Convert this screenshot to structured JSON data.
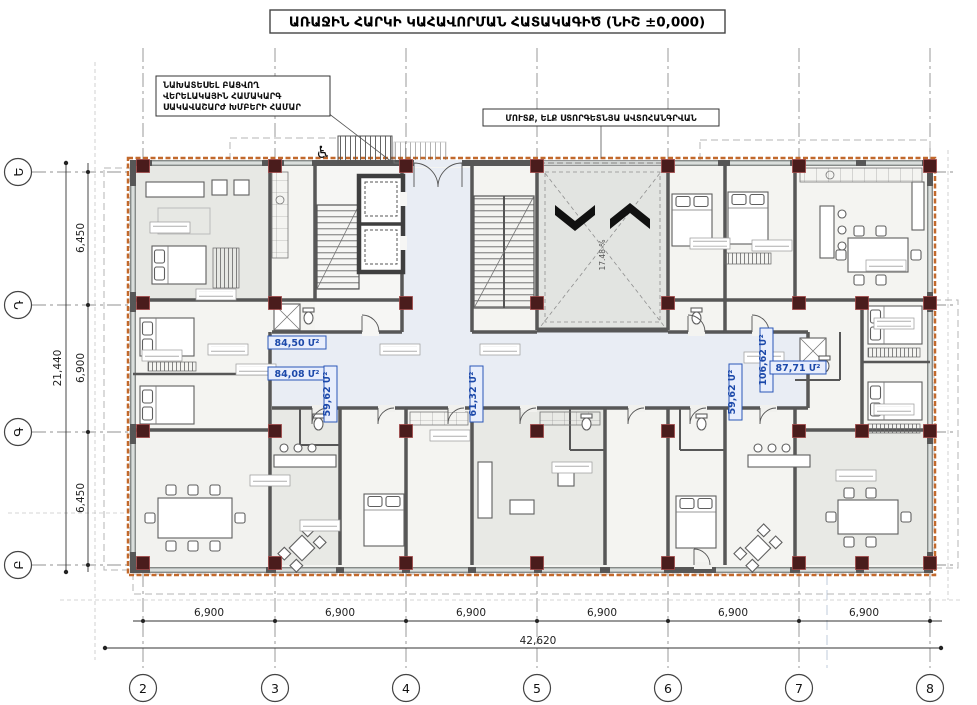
{
  "title": "ԱՌԱՋԻՆ ՀԱՐԿԻ ԿԱՀԱՎՈՐՄԱՆ ՀԱՏԱԿԱԳԻԾ (ՆԻՇ ±0,000)",
  "annotations": {
    "elevator_note": [
      "ՆԱԽԱՏԵՍԵԼ ԲԱՑՎՈՂ",
      "ՎԵՐԵԼԱԿԱՅԻՆ ՀԱՄԱԿԱՐԳ",
      "ՍԱԿԱՎԱՇԱՐԺ ԽՄԲԵՐԻ ՀԱՄԱՐ"
    ],
    "parking_note": "ՄՈՒՏՔ, ԵԼՔ ՍՏՈՐԳԵՏՆՅԱ ԱՎՏՈՀԱՆԳՐՎԱՆ",
    "ramp_slope": "17.48 %"
  },
  "grid": {
    "columns": [
      "2",
      "3",
      "4",
      "5",
      "6",
      "7",
      "8"
    ],
    "rows": [
      "Ե",
      "Դ",
      "Գ",
      "Բ"
    ]
  },
  "dimensions": {
    "h_spans": [
      "6,900",
      "6,900",
      "6,900",
      "6,900",
      "6,900",
      "6,900"
    ],
    "h_total": "42,620",
    "v_spans": [
      "6,450",
      "6,900",
      "6,450"
    ],
    "v_total": "21,440"
  },
  "apartment_areas": {
    "a1": "84,50 Մ²",
    "a2": "84,08 Մ²",
    "a3": "59,62 Մ²",
    "a4": "61,32 Մ²",
    "a5": "59,62 Մ²",
    "a6": "106,62 Մ²",
    "a7": "87,71 Մ²"
  },
  "colors": {
    "wall": "#575757",
    "corridor": "#e9edf4",
    "ramp_zone": "#e2e4e1",
    "insulation": "#c2692c",
    "column": "#4a1c1c",
    "area_label": "#1c49aa"
  }
}
